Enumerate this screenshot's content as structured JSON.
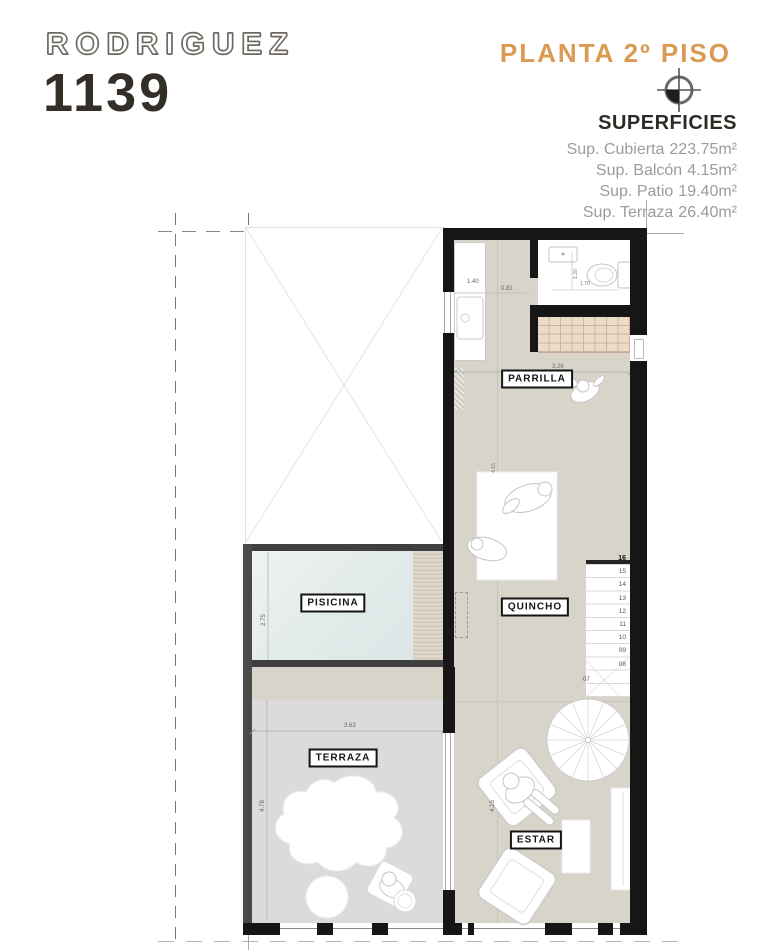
{
  "header": {
    "project_name": "RODRIGUEZ",
    "project_number": "1139",
    "plan_title": "PLANTA 2º PISO",
    "superficies_title": "SUPERFICIES",
    "superficies": [
      {
        "label": "Sup. Cubierta",
        "value": "223.75m²"
      },
      {
        "label": "Sup. Balcón",
        "value": "4.15m²"
      },
      {
        "label": "Sup. Patio",
        "value": "19.40m²"
      },
      {
        "label": "Sup. Terraza",
        "value": "26.40m²"
      }
    ]
  },
  "plan": {
    "room_labels": {
      "pool": "PISICINA",
      "grill": "PARRILLA",
      "quincho": "QUINCHO",
      "terrace": "TERRAZA",
      "living": "ESTAR"
    },
    "dimensions": {
      "patio_width": "1.40",
      "patio_width2": "0.81",
      "bath_depth": "1.20",
      "bath_width": "1.70",
      "grill_width": "3.26",
      "pool_width": "2.75",
      "terrace_width": "3.63",
      "terrace_depth": "4.78",
      "living_depth": "4.15",
      "quincho_dim": "4.15"
    },
    "stairs": {
      "numbers": [
        "16",
        "15",
        "14",
        "13",
        "12",
        "11",
        "10",
        "09",
        "08"
      ],
      "winder_number": "07"
    }
  },
  "colors": {
    "accent_orange": "#DB9A52",
    "wall_black": "#161616",
    "floor_beige": "#D8D4CA",
    "terrace_gray": "#DBDBDD",
    "pool_water": "#E4EBEB",
    "grill_tile": "#ECDBC9",
    "title_dark": "#332E27"
  }
}
